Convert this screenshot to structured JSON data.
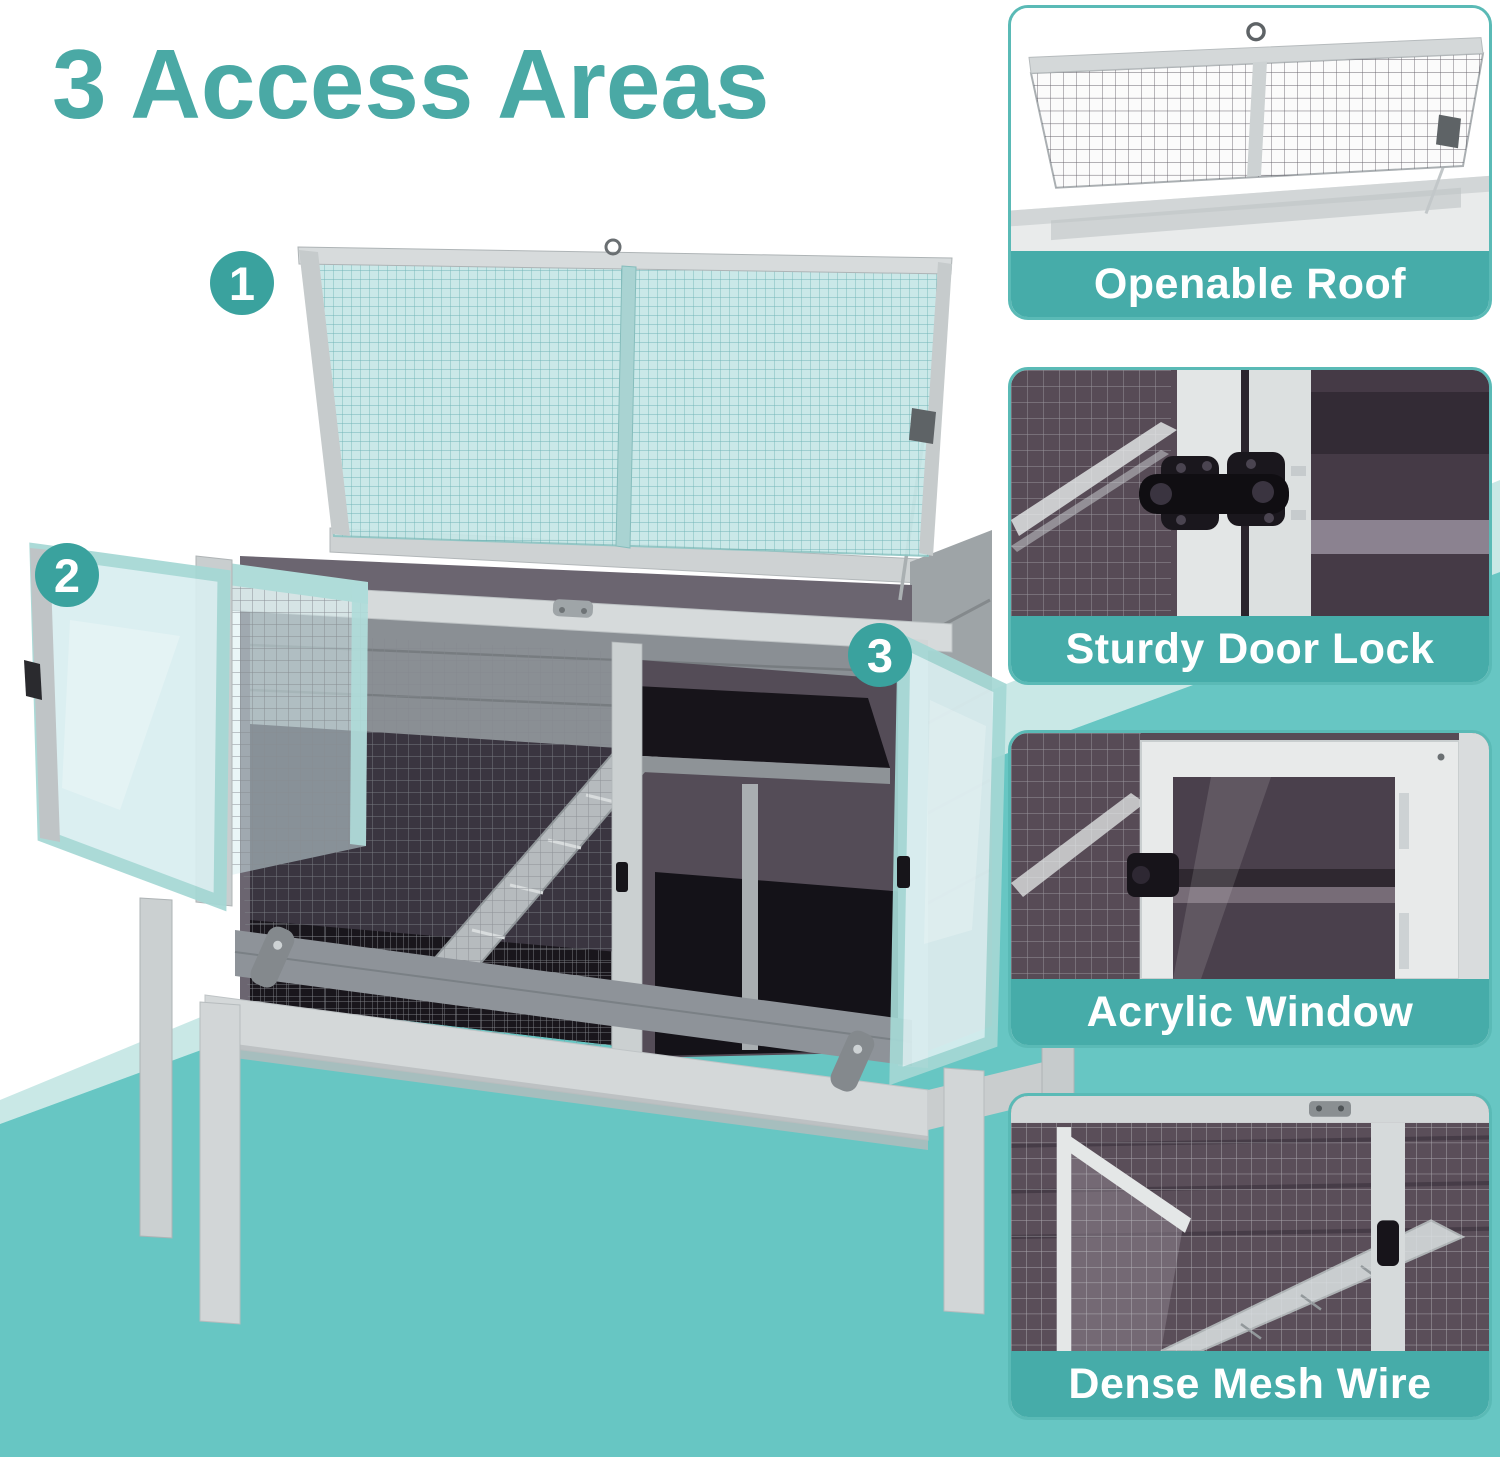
{
  "title": {
    "text": "3 Access Areas"
  },
  "colors": {
    "title_teal": "#4AA9A5",
    "caption_band_teal": "#46ACA9",
    "card_border_teal": "#5ABAB6",
    "background_teal": "#67C6C3",
    "background_mint": "#C9E8E6",
    "marker_teal": "#3AA29E",
    "roof_mesh_tint": "#C6E7E7",
    "wood_grey": "#D4D8D9"
  },
  "markers": [
    {
      "number": "1"
    },
    {
      "number": "2"
    },
    {
      "number": "3"
    }
  ],
  "feature_cards": [
    {
      "caption": "Openable Roof"
    },
    {
      "caption": "Sturdy Door Lock"
    },
    {
      "caption": "Acrylic Window"
    },
    {
      "caption": "Dense Mesh Wire"
    }
  ],
  "product": {
    "description": "Grey wooden small-animal hutch on legs with opened mesh roof lid, two opened acrylic doors, interior ramp and platform"
  }
}
